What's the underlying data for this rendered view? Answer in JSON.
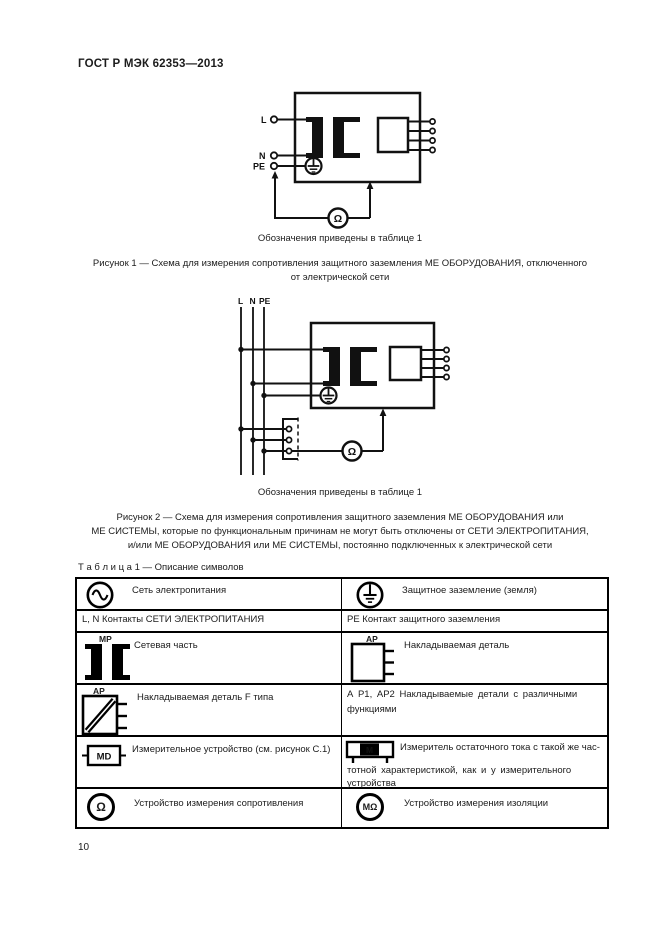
{
  "page": {
    "header": "ГОСТ Р МЭК 62353—2013",
    "page_number": "10"
  },
  "figures": [
    {
      "note": "Обозначения приведены в таблице 1",
      "caption_lines": [
        "Рисунок 1 — Схема для измерения сопротивления защитного заземления МЕ ОБОРУДОВАНИЯ, отключенного",
        "от электрической сети"
      ],
      "terminals": {
        "l": "L",
        "n": "N",
        "pe": "PE"
      },
      "meter_label": "Ω"
    },
    {
      "note": "Обозначения приведены в таблице 1",
      "caption_lines": [
        "Рисунок 2 — Схема для измерения сопротивления защитного заземления МЕ ОБОРУДОВАНИЯ или",
        "МЕ СИСТЕМЫ, которые по функциональным причинам не могут быть отключены от СЕТИ ЭЛЕКТРОПИТАНИЯ,",
        "и/или МЕ ОБОРУДОВАНИЯ или МЕ СИСТЕМЫ, постоянно подключенных к электрической сети"
      ],
      "terminals": {
        "l": "L",
        "n": "N",
        "pe": "PE"
      },
      "meter_label": "Ω"
    }
  ],
  "symbols_table": {
    "title": "Т а б л и ц а  1 — Описание символов",
    "rows": [
      {
        "left_text": "Сеть электропитания",
        "right_text": "Защитное заземление (земля)"
      },
      {
        "left_text": "L, N Контакты СЕТИ ЭЛЕКТРОПИТАНИЯ",
        "right_text": "PE Контакт защитного заземления"
      },
      {
        "left_label": "МР",
        "left_text": "Сетевая часть",
        "right_label": "АР",
        "right_text": "Накладываемая деталь"
      },
      {
        "left_label": "АР",
        "left_text": "Накладываемая деталь F типа",
        "right_lines": [
          "А Р1, АР2 Накладываемые детали с различными",
          "функциями"
        ]
      },
      {
        "left_label": "MD",
        "left_text": "Измерительное устройство (см. рисунок С.1)",
        "right_label": "М",
        "right_lines": [
          "Измеритель остаточного тока с такой же час-",
          "тотной характеристикой, как и у измерительного",
          "устройства"
        ]
      },
      {
        "left_label": "Ω",
        "left_text": "Устройство измерения сопротивления",
        "right_label": "МΩ",
        "right_text": "Устройство измерения изоляции"
      }
    ]
  }
}
